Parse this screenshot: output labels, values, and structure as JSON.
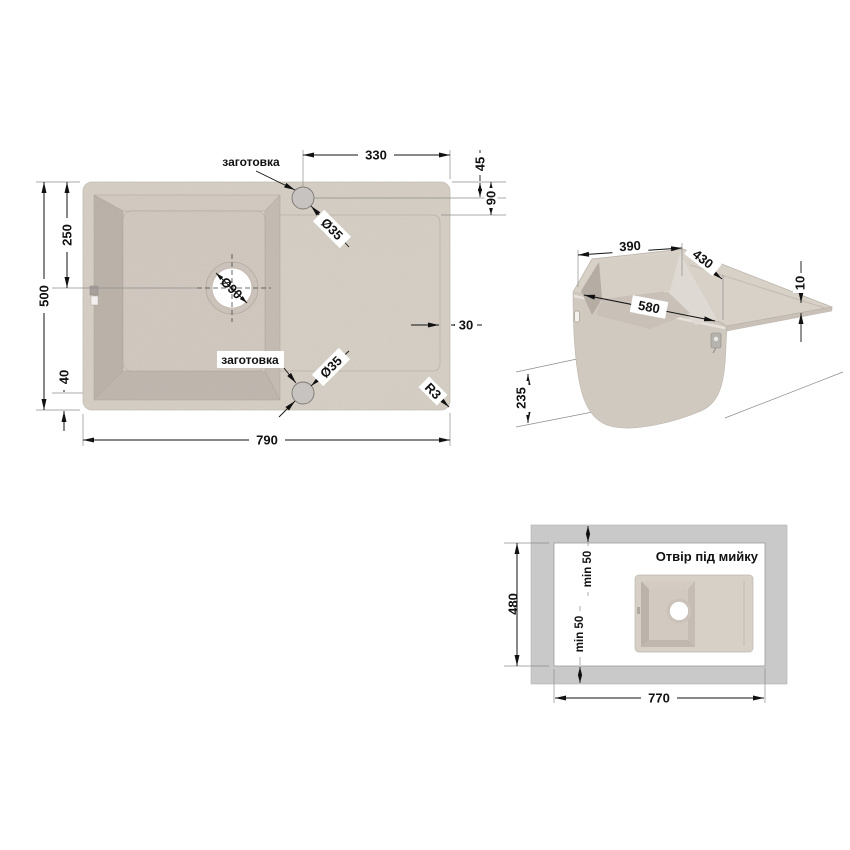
{
  "top_view": {
    "dim_width": "790",
    "dim_height": "500",
    "dim_drain_center": "250",
    "dim_bottom_offset": "40",
    "dim_tap_to_edge": "330",
    "dim_tap_inset": "45",
    "dim_rim_width": "90",
    "dim_edge_width": "30",
    "dim_corner_radius": "R3",
    "dim_drain_diameter": "Ø90",
    "dim_tap_diameter_top": "Ø35",
    "dim_tap_diameter_bottom": "Ø35",
    "label_knockout_top": "заготовка",
    "label_knockout_bottom": "заготовка"
  },
  "iso_view": {
    "dim_bowl_width": "390",
    "dim_bowl_length": "430",
    "dim_bowl_diagonal": "580",
    "dim_board_thickness": "10",
    "dim_bowl_depth": "235"
  },
  "cutout_view": {
    "title": "Отвір під мийку",
    "dim_cutout_height": "480",
    "dim_cutout_width": "770",
    "dim_margin_top": "min 50",
    "dim_margin_bottom": "min 50"
  },
  "colors": {
    "sink_body": "#d8d1c7",
    "bowl_shadow": "#bcb4ab",
    "bowl_inner": "#d3cbc2",
    "drain_hole": "#ffffff",
    "counter_gray": "#c9c9c9",
    "cutout_hole": "#ffffff",
    "dimension_line": "#111111"
  }
}
